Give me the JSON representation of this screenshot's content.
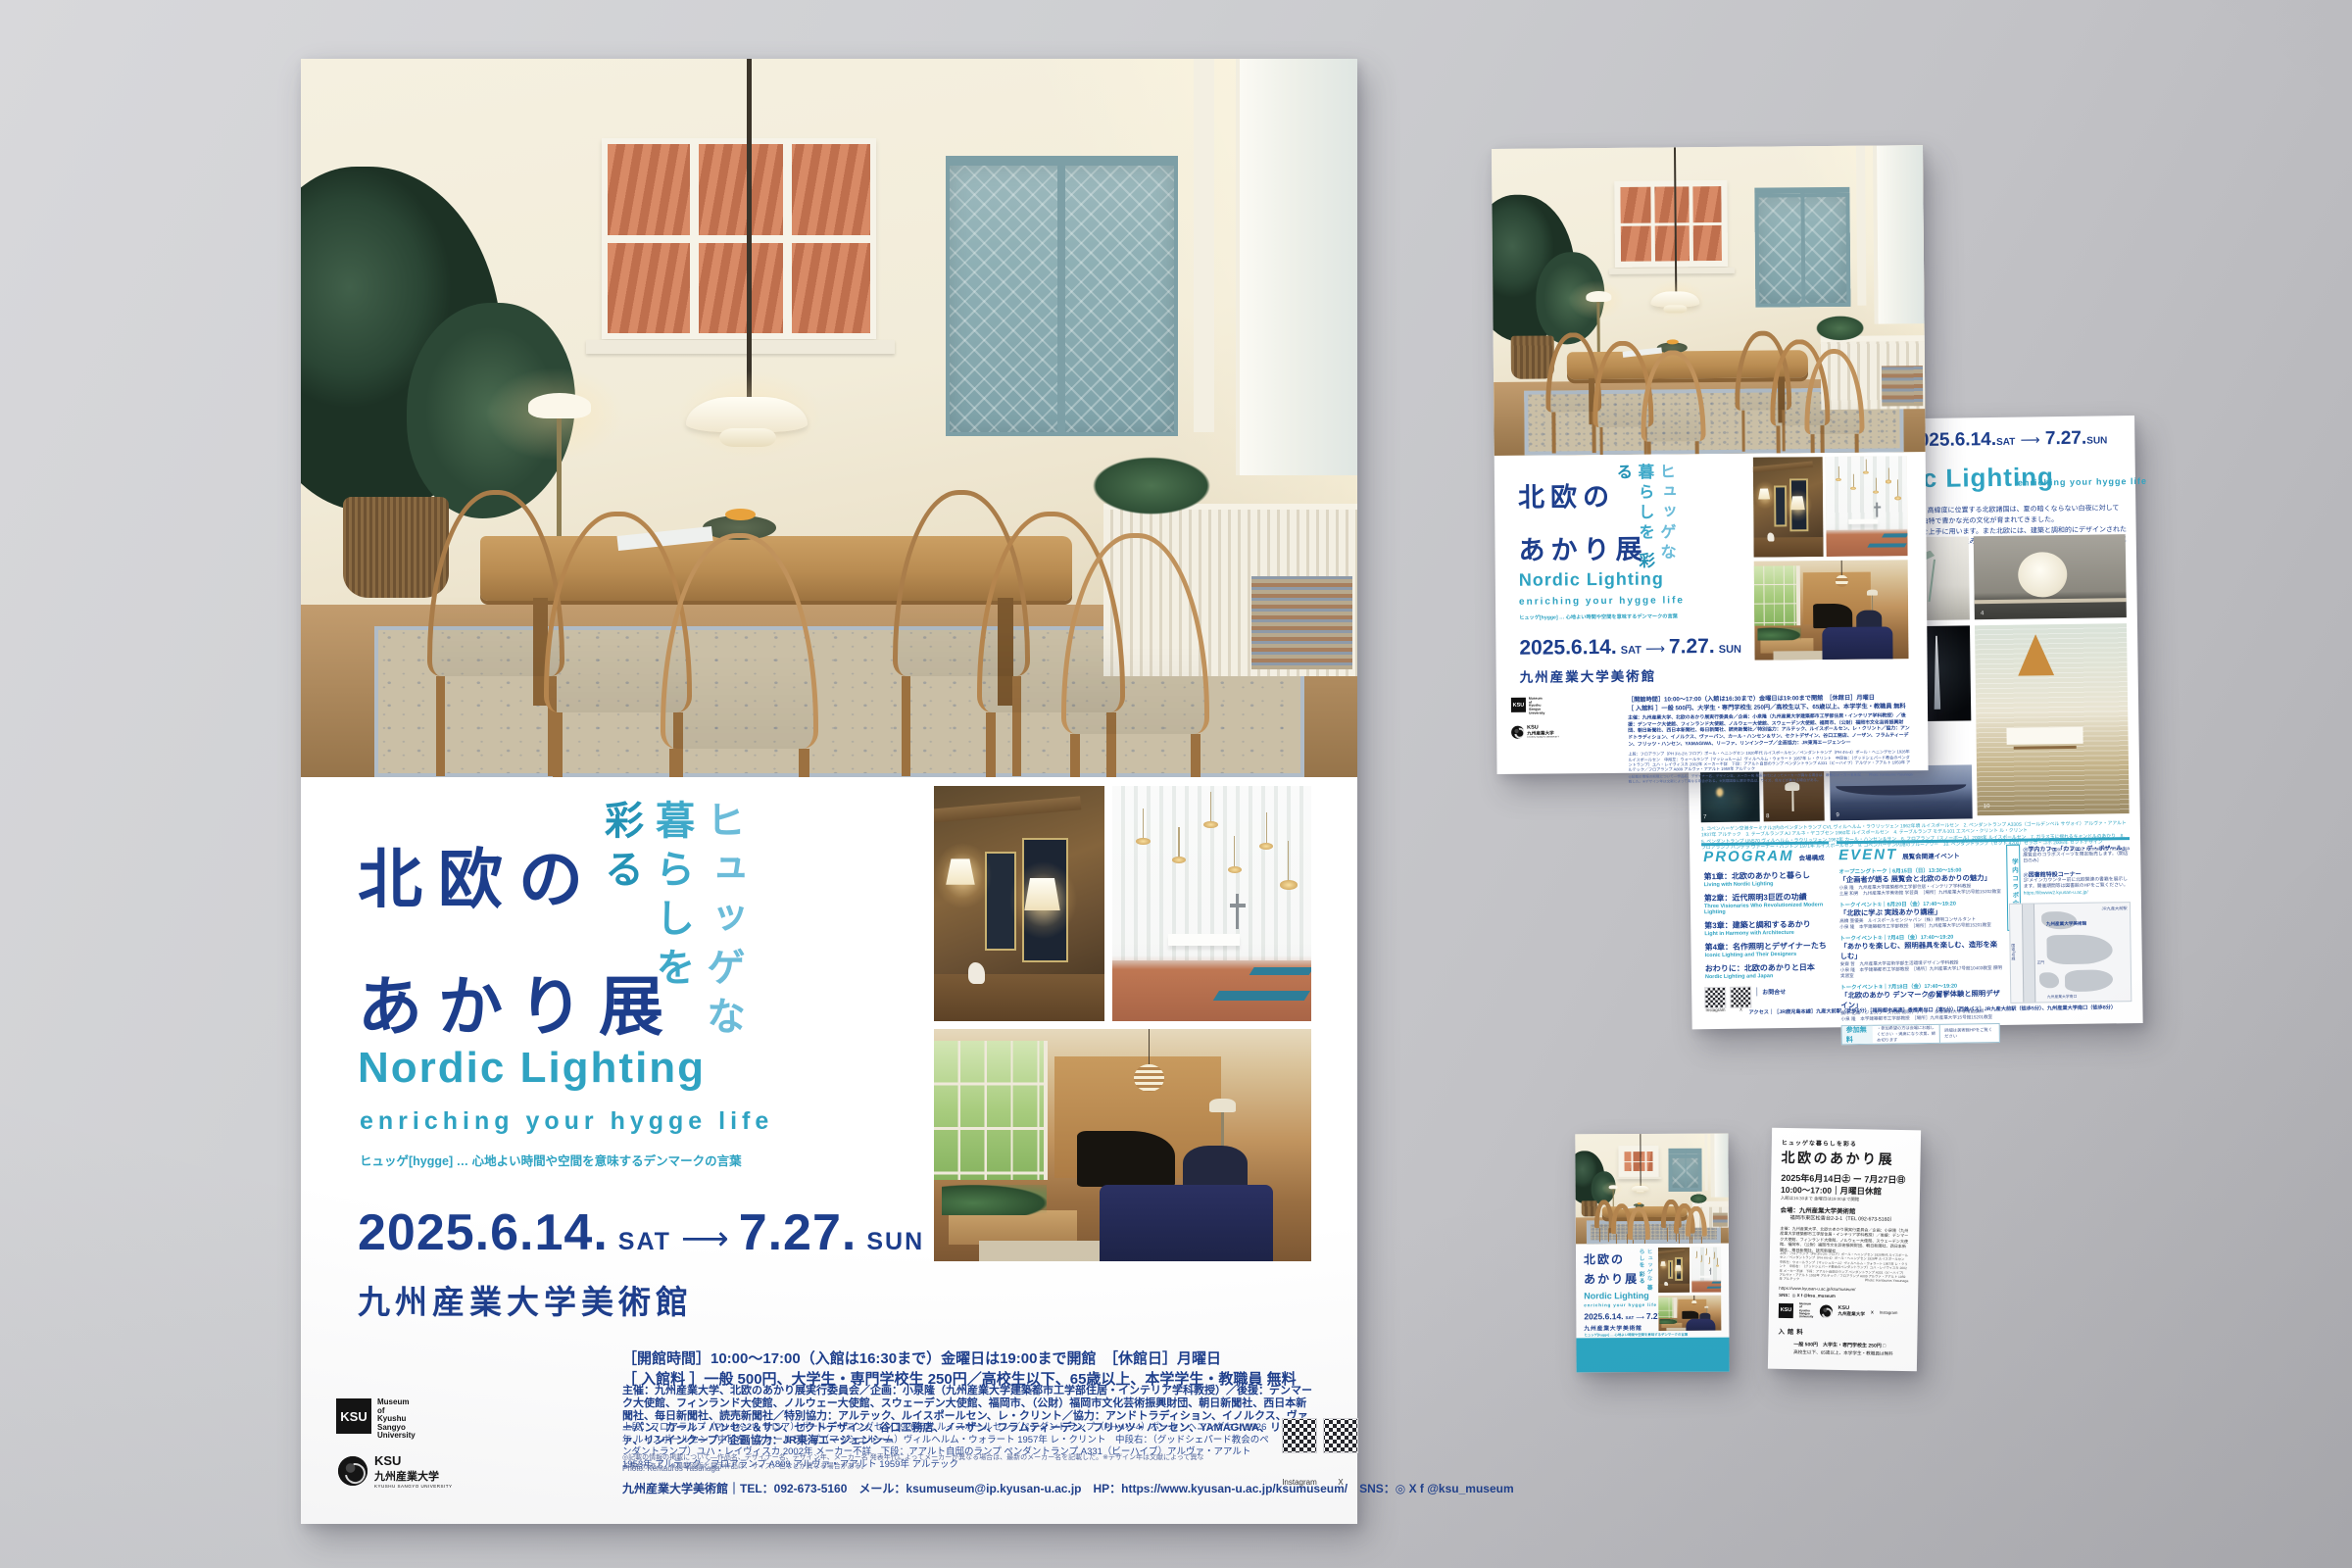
{
  "colors": {
    "navy": "#1d3e8c",
    "teal": "#2fa3c2",
    "teal_light": "#6cbcd9",
    "band_teal": "#2aa6c3",
    "background_gray": "#c6c6ca"
  },
  "poster": {
    "tagline": [
      "ヒュッゲな",
      "暮らしを",
      "彩る"
    ],
    "title_lines": [
      "北欧の",
      "あかり展"
    ],
    "title_compact": "北欧のあかり展",
    "en_title": "Nordic Lighting",
    "en_subtitle": "enriching your hygge life",
    "hygge_note": "ヒュッゲ[hygge] … 心地よい時間や空間を意味するデンマークの言葉",
    "date": {
      "start": "2025.6.14.",
      "start_day": "SAT",
      "arrow": "⟶",
      "end": "7.27.",
      "end_day": "SUN"
    },
    "venue": "九州産業大学美術館",
    "hours": "［開館時間］10:00～17:00（入館は16:30まで）金曜日は19:00まで開館　［休館日］月曜日",
    "admission": "［ 入館料 ］一般 500円、大学生・専門学校生 250円／高校生以下、65歳以上、本学学生・教職員 無料",
    "organizers": "主催：九州産業大学、北欧のあかり展実行委員会／企画：小泉隆（九州産業大学建築都市工学部住居・インテリア学科教授）／後援：デンマーク大使館、フィンランド大使館、ノルウェー大使館、スウェーデン大使館、福岡市、（公財）福岡市文化芸術振興財団、朝日新聞社、西日本新聞社、毎日新聞社、読売新聞社／特別協力：アルテック、ルイスポールセン、レ・クリント／協力：アンドトラディション、イノルクス、ヴァーパン、カール・ハンセン＆サン、セクトデザイン、谷口工務店、ノーザン、フラムティーデン、フリッツ・ハンセン、YAMAGIWA、リーファ、リンインクープ／企画協力：JR東海エージェンシー",
    "works_credit": "上段：フロアランプ（PH 3½-2½ フロア）ポール・ヘニングセン 1920年代 ルイスポールセン／ペンダントランプ（PH 4½-4）ポール・ヘニングセン 1926年 ルイスポールセン　中段左：ウォールランプ（マッシュルーム）ヴィルヘルム・ウォラート 1957年 レ・クリント　中段右：（グッドシェパード教会のペンダントランプ）ユハ・レイヴィスカ 2002年 メーカー不詳　下段：アアルト自邸のランプ ペンダントランプ A331（ビーハイブ）アルヴァ・アアルト 1953年 アルテック／フロアランプ A809 アルヴァ・アアルト 1959年 アルテック",
    "works_note": "◎記載の情報の掲載について—作品名、デザイナー名、デザイン年、メーカー名 発表年代によってメーカーが異なる場合は、最新のメーカー名を記載した。※デザイン年は文献によって異なる場合がある。※掲載図版と展示作品は、サイズ、色などが異なる場合がある。",
    "photo_credit": "Photo: Kentauros Yasunaga",
    "contact": "九州産業大学美術館｜TEL：092-673-5160　メール：ksumuseum@ip.kyusan-u.ac.jp　HP：https://www.kyusan-u.ac.jp/ksumuseum/　SNS：◎ X f @ksu_museum",
    "qr_labels": [
      "Instagram",
      "X"
    ],
    "museum_logo": {
      "mark": "KSU",
      "text": "Museum\nof\nKyushu\nSangyo\nUniversity"
    },
    "univ_logo": {
      "mark": "KSU",
      "ja": "九州産業大学",
      "en": "KYUSHU SANGYO UNIVERSITY"
    }
  },
  "flyer_back": {
    "nordic": "Nordic Lighting",
    "nordic_sub": "enriching your hygge life",
    "intro_lines": [
      "があります。高緯度に位置する北欧諸国は、夏の暗くならない白夜に対して",
      "は古くから独特で豊かな光の文化が育まれてきました。",
      "『あかり』を上手に用います。また北欧には、建築と調和的にデザインされた",
      "北欧の名作照明とそれを生み出したデザイナーたち、さらには北欧のあかりと",
      "く展覧会です。"
    ],
    "caption_line1": "1. コペンハーゲン空港ターミナル2内のペンダントランプ CVL ヴィルヘルム・ラウリッツェン 1962年頃 ルイスポールセン　2. ペンダントランプ A330S（ゴールデンベル サヴォイ）アルヴァ・アアルト 1937年 アルテック　3. テーブルランプ AJ アルネ・ヤコブセン 1960年 ルイスポールセン　4. テーブルランプ モデル101 エスベン・クリント ル・クリント",
    "caption_line2": "5. ペンダントランプ UN570 ヴィルヘルム・ラウリッツェン 1962年 カール・ハンセン＆サン　6. フロアランプ（スノーボール）2008年 ルイスポールセン　7. ガラス玉に揺れるキャンドルのあかり　8. フロアランプ パンテラ ヴァーナー・パントン 1971年 ルイスポールセン　9. コペンハーゲン内港のブルーアワー　10. ペンダントランプ（セクト 4200）セッポ・コホ 2006年 セクトデザイン",
    "caption_credit": "Photo 1,7,8,9,10: Kentauros Yasunaga",
    "photo_numbers": {
      "aj": "3",
      "globe": "4",
      "tower": "6",
      "candles": "7",
      "tulip": "8",
      "bridge": "9",
      "dining": "10"
    },
    "program": {
      "heading": "PROGRAM",
      "sub": "会場構成",
      "items": [
        {
          "ja": "第1章：北欧のあかりと暮らし",
          "en": "Living with Nordic Lighting"
        },
        {
          "ja": "第2章：近代照明3巨匠の功績",
          "en": "Three Visionaries Who Revolutionized Modern Lighting"
        },
        {
          "ja": "第3章：建築と調和するあかり",
          "en": "Light in Harmony with Architecture"
        },
        {
          "ja": "第4章：名作照明とデザイナーたち",
          "en": "Iconic Lighting and Their Designers"
        },
        {
          "ja": "おわりに：北欧のあかりと日本",
          "en": "Nordic Lighting and Japan"
        }
      ]
    },
    "inquiry_label": "お問合せ",
    "event": {
      "heading": "EVENT",
      "sub": "展覧会関連イベント",
      "items": [
        {
          "label": "オープニングトーク｜6月15日（日）13:30～15:00",
          "title": "「企画者が語る 展覧会と北欧のあかりの魅力」",
          "line1": "小泉 隆　九州産業大学建築都市工学部住居・インテリア学科教授",
          "line2": "土屋 和男　九州産業大学美術館 学芸員　［場所］九州産業大学15号館15202教室"
        },
        {
          "label": "トークイベント①｜6月20日（金）17:40～19:20",
          "title": "「北欧に学ぶ 実践あかり講座」",
          "line1": "高橋 亜優美　ルイスポールセンジャパン（株）照明コンサルタント",
          "line2": "小泉 隆　本学建築都市工学部教授　［場所］九州産業大学15号館15201教室"
        },
        {
          "label": "トークイベント②｜7月4日（金）17:40～19:20",
          "title": "「あかりを楽しむ、照明器具を楽しむ、造形を楽しむ」",
          "line1": "安齋 哲　九州産業大学芸術学部生活環境デザイン学科教授",
          "line2": "小泉 隆　本学建築都市工学部教授　［場所］九州産業大学17号館10403教室 照明実習室"
        },
        {
          "label": "トークイベント③｜7月18日（金）17:40～19:20",
          "title": "「北欧のあかり デンマークの留学体験と照明デザイン」",
          "line1": "廣木 花織　ジェスフース代表 照明デザイナー 多摩美術大学非常勤講師",
          "line2": "小泉 隆　本学建築都市工学部教授　［場所］九州産業大学15号館15201教室"
        }
      ]
    },
    "free": {
      "label": "参加無料",
      "notes": "・参加希望の方は会場にお越しください ・満席になり次第、締め切ります",
      "right": "詳細は美術館HPをご覧ください"
    },
    "collab": {
      "label": "学内コラボ企画",
      "item1_title": "◎学内カフェ「カフェ・デ・ボザール」",
      "item1_desc": "展覧会のコラボスイーツを限定販売します。（開店日のみ）",
      "item2_title": "◎図書館特設コーナー",
      "item2_desc": "1Fメインカウンター前に北欧関連の書籍を展示します。開催期間等は図書館のHPをご覧ください。",
      "item2_url": "https://libwww2.kyusan-u.ac.jp/"
    },
    "map": {
      "museum": "九州産業大学美術館",
      "station": "JR九産大前駅",
      "road": "国道3号線",
      "gate": "正門",
      "south": "九州産業大学南口"
    },
    "sns_icons": "◎ X f",
    "access": "アクセス｜［JR鹿児島本線］九産大前駅（徒歩5分）［福岡都市高速］香椎東出口（車5分）［西鉄バス］JR九産大前駅（徒歩5分）、九州産業大学南口（徒歩8分）"
  },
  "ticket_back": {
    "tagline": "ヒュッゲな暮らしを彩る",
    "title": "北欧のあかり展",
    "date": "2025年6月14日㊏ ー 7月27日㊐",
    "hours": "10:00～17:00｜月曜日休館",
    "note": "入館は16:30まで 金曜日は19:00まで開館",
    "venue": "会場：九州産業大学美術館",
    "addr": "福岡市東区松香台2-3-1（TEL 092-673-5160）",
    "org": "主催：九州産業大学、北欧のあかり展実行委員会／企画：小泉隆（九州産業大学建築都市工学部住居・インテリア学科教授）／後援：デンマーク大使館、フィンランド大使館、ノルウェー大使館、スウェーデン大使館、福岡市、（公財）福岡市文化芸術振興財団、朝日新聞社、西日本新聞社、毎日新聞社、読売新聞社",
    "url": "https://www.kyusan-u.ac.jp/ksumuseum/",
    "sns": "SNS：◎ X f @ksu_museum",
    "x_label": "X",
    "ig_label": "Instagram",
    "fee_label": "入館料",
    "fee1": "一般 500円　大学生・専門学校生 250円 □",
    "fee2": "高校生以下、65歳以上、本学学生・教職員は無料"
  }
}
